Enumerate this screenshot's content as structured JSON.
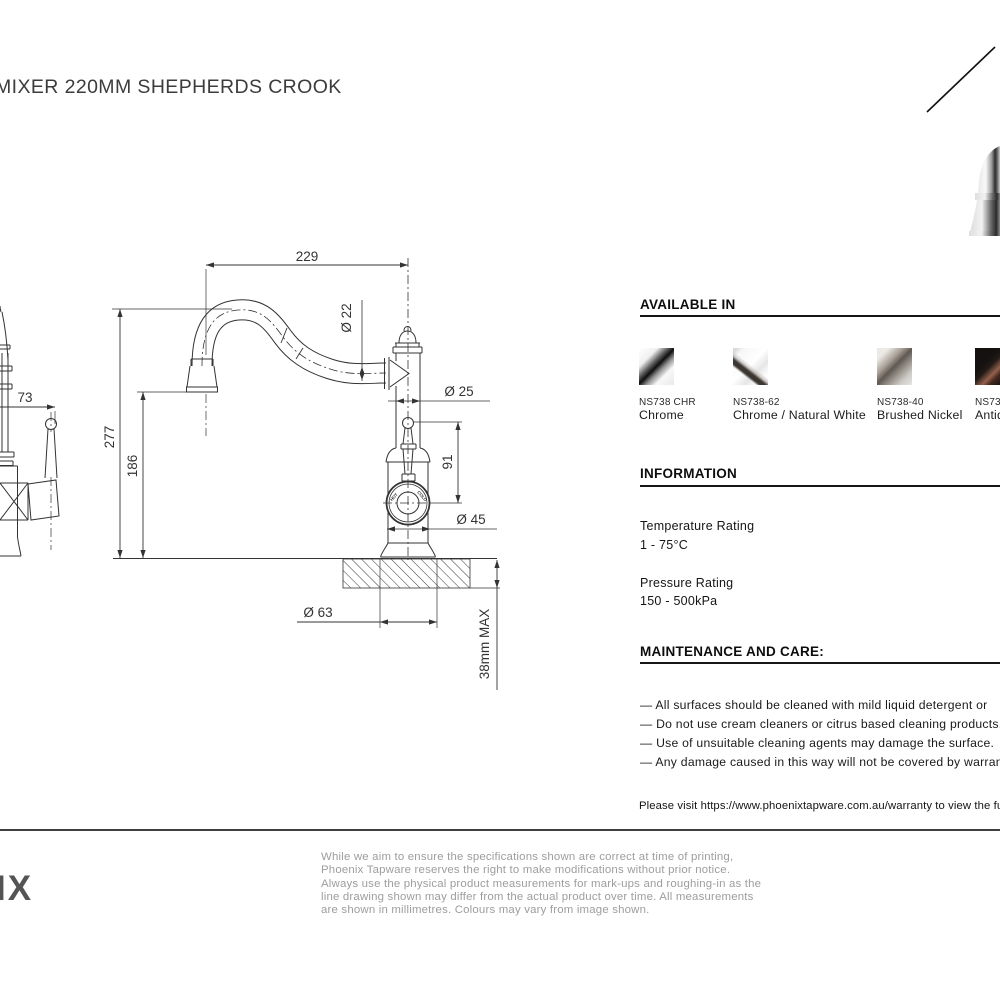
{
  "title": "MIXER 220MM SHEPHERDS CROOK",
  "logo_fragment": "IX",
  "drawing": {
    "dims": {
      "spout_reach": "229",
      "spout_dia": "Ø 22",
      "body_dia": "Ø 25",
      "overall_height": "277",
      "outlet_height": "186",
      "handle_height": "91",
      "body_width_dia": "Ø 45",
      "base_dia": "Ø 63",
      "bench_thickness": "38mm MAX",
      "side_reach": "73",
      "hot_label": "HOT",
      "cold_label": "COLD"
    }
  },
  "available_in": {
    "heading": "AVAILABLE IN",
    "finishes": [
      {
        "code": "NS738 CHR",
        "name": "Chrome"
      },
      {
        "code": "NS738-62",
        "name": "Chrome / Natural White"
      },
      {
        "code": "NS738-40",
        "name": "Brushed Nickel"
      },
      {
        "code": "NS738",
        "name": "Antiq"
      }
    ]
  },
  "information": {
    "heading": "INFORMATION",
    "items": [
      {
        "label": "Temperature Rating",
        "value": "1 - 75°C"
      },
      {
        "label": "Pressure Rating",
        "value": "150 - 500kPa"
      }
    ]
  },
  "maintenance": {
    "heading": "MAINTENANCE AND CARE:",
    "bullets": [
      "— All surfaces should be cleaned with mild liquid detergent or",
      "— Do not use cream cleaners or citrus based cleaning products,",
      "— Use of unsuitable cleaning agents may damage the surface.",
      "— Any damage caused in this way will not be covered by warran"
    ],
    "warranty_note": "Please visit https://www.phoenixtapware.com.au/warranty to view the full"
  },
  "disclaimer": {
    "lines": [
      "While we aim to ensure the specifications shown are correct at time of printing,",
      "Phoenix Tapware reserves the right to make modifications without prior notice.",
      "Always use the physical product measurements for mark-ups and roughing-in as the",
      "line drawing shown may differ from the actual product over time. All measurements",
      "are shown in millimetres. Colours may vary from image shown."
    ]
  },
  "colors": {
    "line": "#333333",
    "heading": "#0d0d0d",
    "disclaimer_text": "#9d9d9d",
    "rule": "#3f3f3f"
  }
}
